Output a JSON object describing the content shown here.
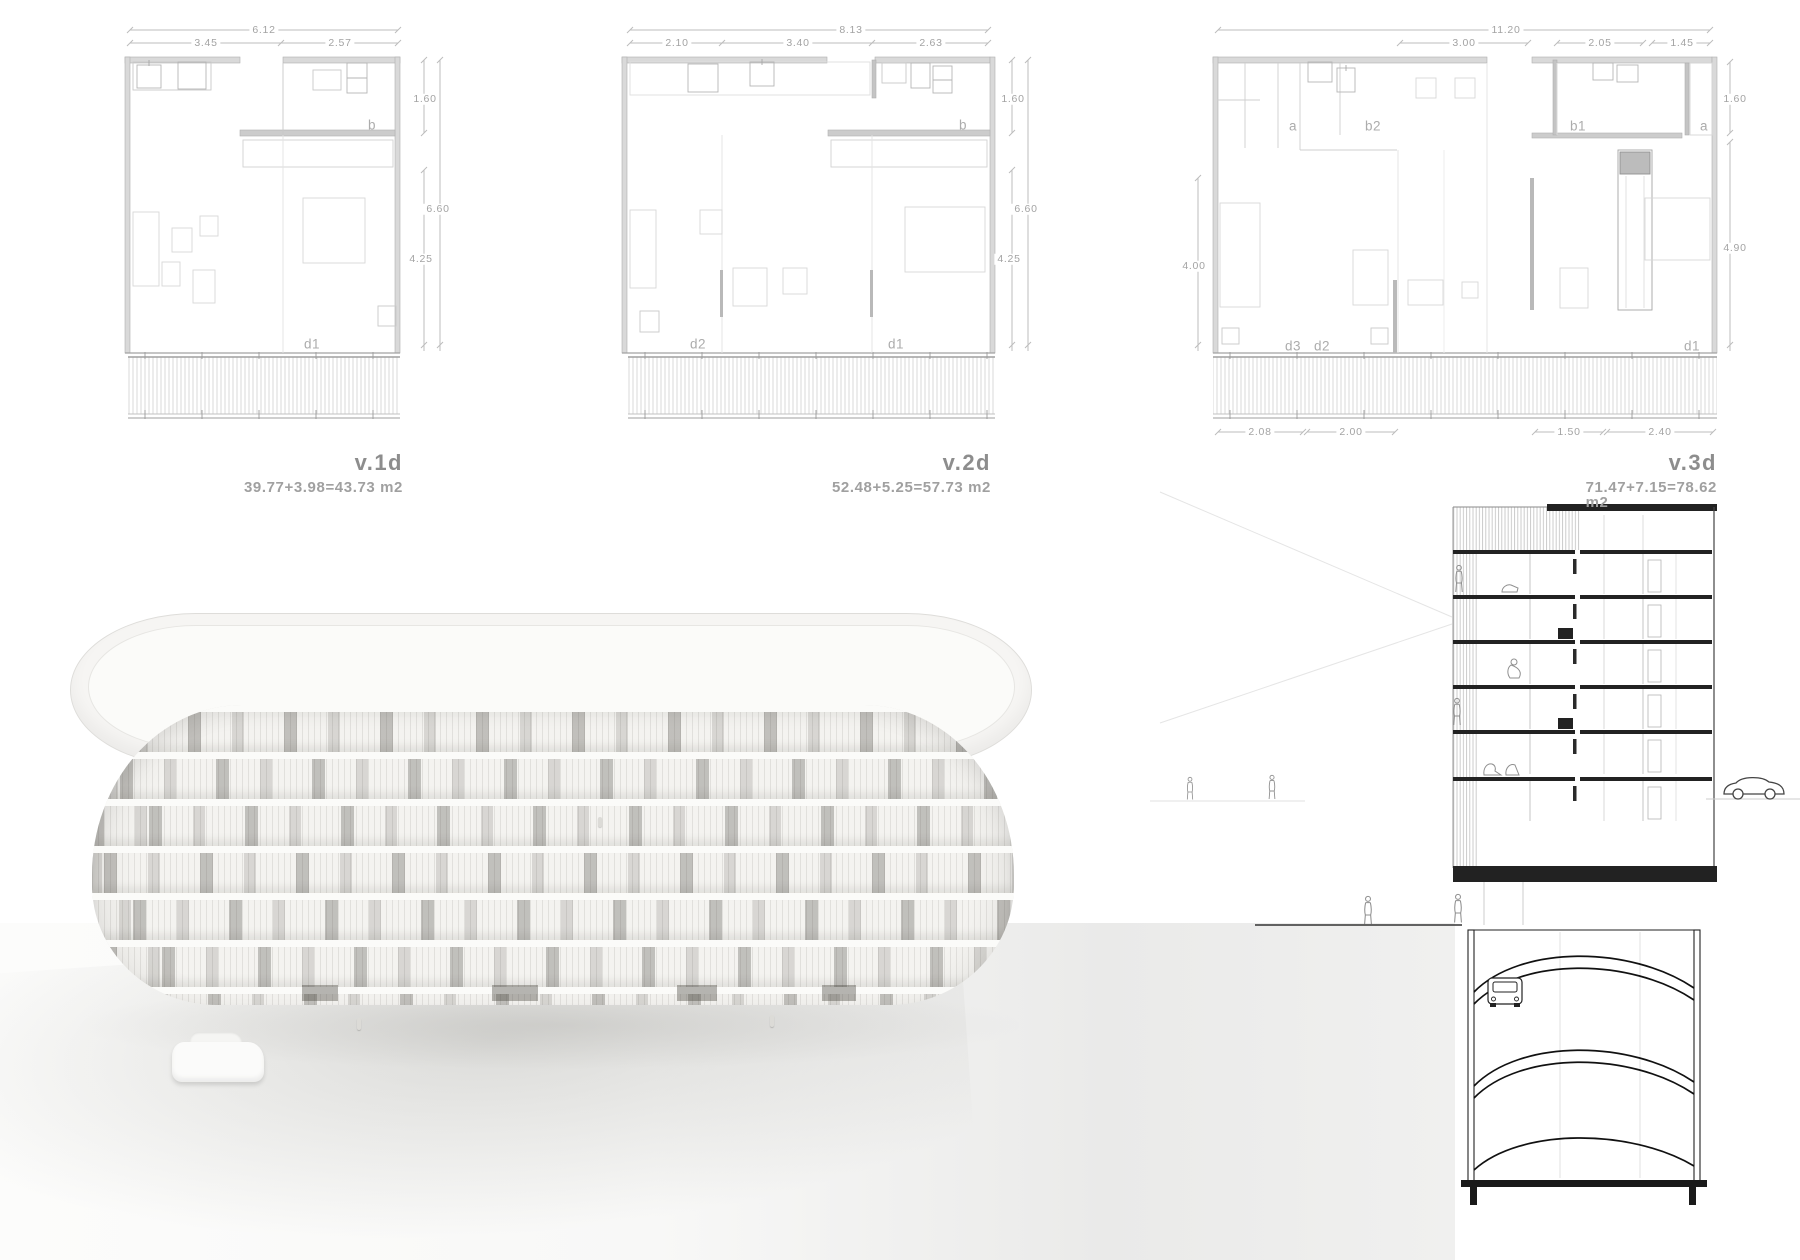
{
  "board": {
    "background": "#ffffff"
  },
  "colors": {
    "plan_line_light": "#c9c9c9",
    "plan_wall_fill": "#d9d9d9",
    "section_line_dark": "#222222",
    "text_gray": "#a0a0a0",
    "title_gray": "#8d8d8d"
  },
  "plans": [
    {
      "title": "v.1d",
      "area": "39.77+3.98=43.73 m2",
      "dims": {
        "total": "6.12",
        "seg1": "3.45",
        "seg2": "2.57",
        "right_top": "1.60",
        "right_outer": "6.60",
        "right_inner": "4.25"
      },
      "labels": {
        "b": "b",
        "d1": "d1"
      }
    },
    {
      "title": "v.2d",
      "area": "52.48+5.25=57.73 m2",
      "dims": {
        "total": "8.13",
        "seg1": "2.10",
        "seg2": "3.40",
        "seg3": "2.63",
        "right_top": "1.60",
        "right_outer": "6.60",
        "right_inner": "4.25"
      },
      "labels": {
        "b": "b",
        "d2": "d2",
        "d1": "d1"
      }
    },
    {
      "title": "v.3d",
      "area": "71.47+7.15=78.62 m2",
      "dims": {
        "total": "11.20",
        "seg1": "3.00",
        "seg2": "2.05",
        "seg3": "1.45",
        "left": "4.00",
        "right_top": "1.60",
        "right_lower": "4.90",
        "bottom1": "2.08",
        "bottom2": "2.00",
        "bottom3": "1.50",
        "bottom4": "2.40"
      },
      "labels": {
        "a1": "a",
        "b2": "b2",
        "b1": "b1",
        "a2": "a",
        "d3": "d3",
        "d2": "d2",
        "d1": "d1"
      }
    }
  ]
}
